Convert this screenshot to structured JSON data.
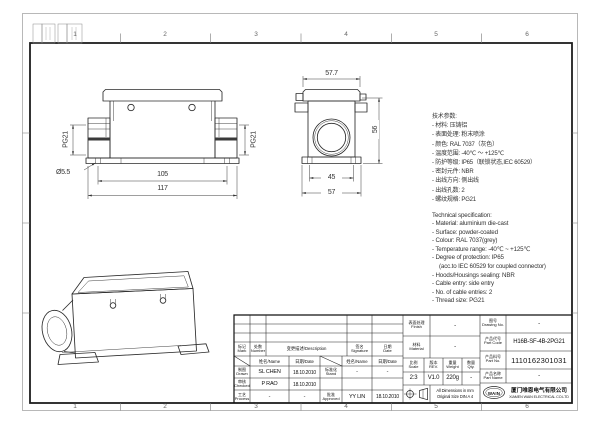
{
  "zones": {
    "top": [
      "1",
      "2",
      "3",
      "4",
      "5",
      "6"
    ],
    "bottom": [
      "1",
      "2",
      "3",
      "4",
      "5",
      "6"
    ]
  },
  "views": {
    "front": {
      "dim_overall": "117",
      "dim_holes": "105",
      "dim_hole_dia": "Ø5.5",
      "thread_left": "PG21",
      "thread_right": "PG21"
    },
    "side": {
      "dim_width_top": "57.7",
      "dim_inner": "45",
      "dim_overall": "57",
      "dim_height": "56"
    }
  },
  "specs_cn": {
    "title": "技术参数:",
    "items": [
      "- 材料: 压铸铝",
      "- 表面处理: 粉末喷涂",
      "- 颜色: RAL 7037（灰色）",
      "- 温度范围: -40℃ ～ +125℃",
      "- 防护等级: IP65（联锁状态,IEC 60529）",
      "- 密封元件: NBR",
      "- 出线方向: 侧出线",
      "- 出线孔数: 2",
      "- 螺纹规格: PG21"
    ]
  },
  "specs_en": {
    "title": "Technical specification:",
    "items": [
      "- Material: aluminium die-cast",
      "- Surface: powder-coated",
      "- Colour: RAL 7037(grey)",
      "- Temperature range: -40℃ ~ +125℃",
      "- Degree of protection: IP65",
      "(acc.to IEC 60529 for coupled connector)",
      "- Hoods/Housings sealing: NBR",
      "- Cable entry: side entry",
      "- No. of cable entries: 2",
      "- Thread size: PG21"
    ]
  },
  "title_block": {
    "revision_header": {
      "mark_cn": "标记",
      "mark_en": "Mark",
      "count_cn": "处数",
      "count_en": "Number",
      "description": "变更描述/Description",
      "signature_cn": "签名",
      "signature_en": "Signature",
      "date_cn": "日期",
      "date_en": "Date"
    },
    "sign_header": {
      "name": "姓名/Name",
      "date": "日期/Date"
    },
    "signatures": {
      "drawn": {
        "label_cn": "制图",
        "label_en": "Drawn",
        "name": "SL CHEN",
        "date": "18.10.2010"
      },
      "checked": {
        "label_cn": "审核",
        "label_en": "Checked",
        "name": "P RAO",
        "date": "18.10.2010"
      },
      "process": {
        "label_cn": "工艺",
        "label_en": "Process",
        "name": "-",
        "date": "-"
      },
      "standard": {
        "label_cn": "标准化",
        "label_en": "Stand",
        "name": "-",
        "date": "-"
      },
      "approved": {
        "label_cn": "批准",
        "label_en": "Approved",
        "name": "YY LIN",
        "date": "18.10.2010"
      }
    },
    "info": {
      "finish": {
        "label_cn": "表面处理",
        "label_en": "Finish",
        "value": "-"
      },
      "material": {
        "label_cn": "材料",
        "label_en": "Material",
        "value": "-"
      },
      "scale": {
        "label_cn": "比例",
        "label_en": "Scale",
        "value": "2:3"
      },
      "rev": {
        "label_cn": "版本",
        "label_en": "REV.",
        "value": "V1.0"
      },
      "weight": {
        "label_cn": "重量",
        "label_en": "Weight",
        "value": "220g"
      },
      "qty": {
        "label_cn": "数量",
        "label_en": "Qty.",
        "value": "-"
      },
      "drawing_no": {
        "label_cn": "图号",
        "label_en": "Drawing No.",
        "value": "-"
      },
      "part_code": {
        "label_cn": "产品代号",
        "label_en": "Part Code",
        "value": "H16B-SF-4B-2PG21"
      },
      "part_no": {
        "label_cn": "产品料号",
        "label_en": "Part No.",
        "value": "1110162301031"
      },
      "part_name": {
        "label_cn": "产品名称",
        "label_en": "Part Name",
        "value": "-"
      }
    },
    "notes": {
      "line1": "All Dimensions in mm",
      "line2": "Original Size DIN A 4"
    },
    "company": {
      "logo": "WAIN",
      "name_cn": "厦门唯恩电气有限公司",
      "name_en": "XIAMEN WAIN ELECTRICAL CO.LTD"
    }
  }
}
